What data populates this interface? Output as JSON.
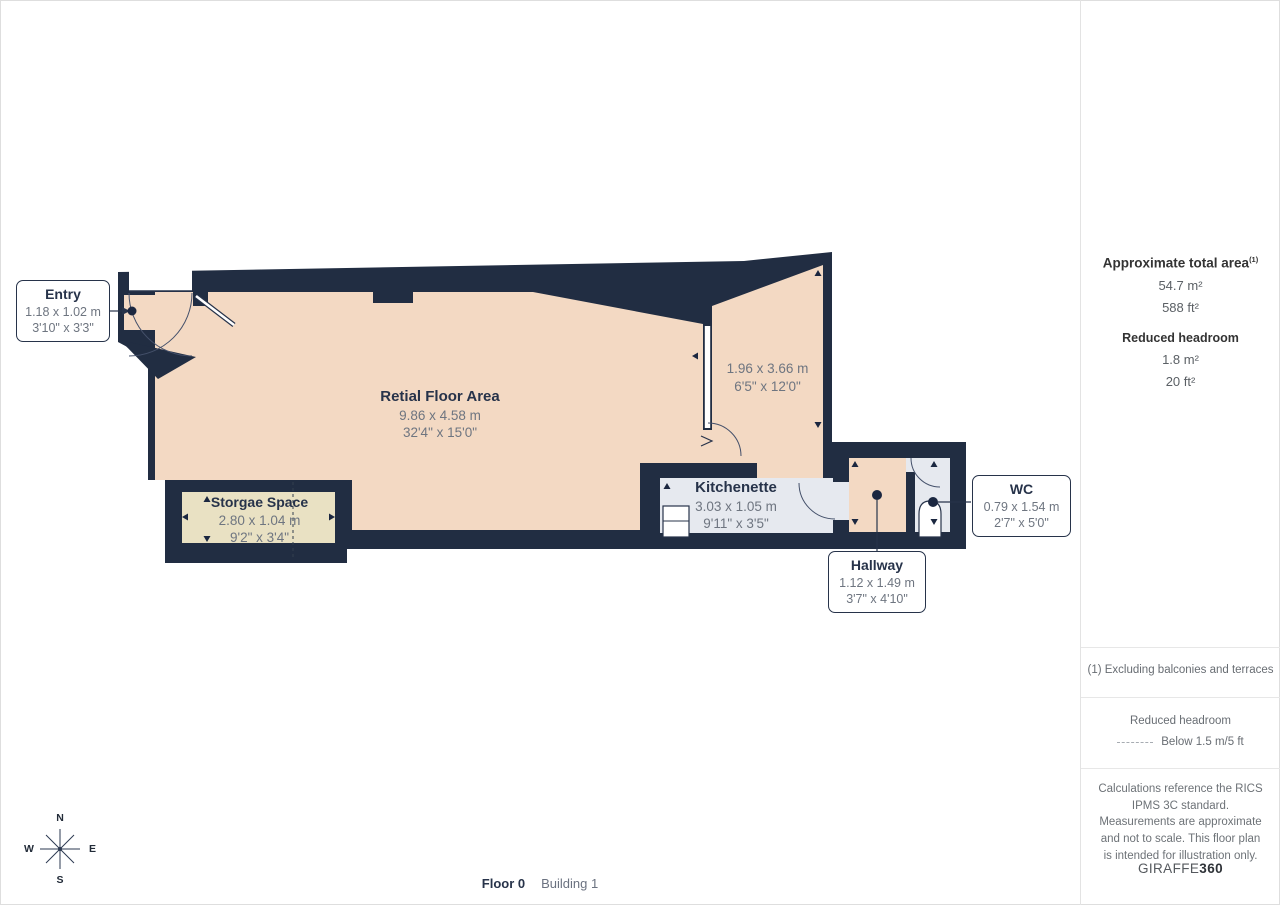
{
  "rooms": {
    "retail": {
      "name": "Retial Floor Area",
      "dim_m": "9.86 x 4.58 m",
      "dim_ft": "32'4\" x 15'0\""
    },
    "side_room": {
      "dim_m": "1.96 x 3.66 m",
      "dim_ft": "6'5\" x 12'0\""
    },
    "storage": {
      "name": "Storgae Space",
      "dim_m": "2.80 x 1.04 m",
      "dim_ft": "9'2\" x 3'4\""
    },
    "kitchenette": {
      "name": "Kitchenette",
      "dim_m": "3.03 x 1.05 m",
      "dim_ft": "9'11\" x 3'5\""
    },
    "hallway": {
      "name": "Hallway",
      "dim_m": "1.12 x 1.49 m",
      "dim_ft": "3'7\" x 4'10\""
    },
    "wc": {
      "name": "WC",
      "dim_m": "0.79 x 1.54 m",
      "dim_ft": "2'7\" x 5'0\""
    },
    "entry": {
      "name": "Entry",
      "dim_m": "1.18 x 1.02 m",
      "dim_ft": "3'10\" x 3'3\""
    }
  },
  "sidebar": {
    "total_area_label": "Approximate total area",
    "total_area_footnote_mark": "(1)",
    "total_area_m2": "54.7 m²",
    "total_area_ft2": "588 ft²",
    "reduced_headroom_label": "Reduced headroom",
    "reduced_headroom_m2": "1.8 m²",
    "reduced_headroom_ft2": "20 ft²",
    "footnote": "(1) Excluding balconies and terraces",
    "legend_title": "Reduced headroom",
    "legend_text": "Below 1.5 m/5 ft",
    "disclaimer": "Calculations reference the RICS IPMS 3C standard. Measurements are approximate and not to scale. This floor plan is intended for illustration only.",
    "brand_name": "GIRAFFE",
    "brand_suffix": "360"
  },
  "footer": {
    "floor_label": "Floor 0",
    "building_label": "Building 1"
  },
  "compass": {
    "north": "N",
    "east": "E",
    "south": "S",
    "west": "W"
  },
  "colors": {
    "wall": "#212d42",
    "floor": "#f3d9c3",
    "storage_floor": "#e9e1c3",
    "wet_floor": "#e6e9ef",
    "label_text": "#27334a",
    "dim_text": "#6e7580"
  }
}
